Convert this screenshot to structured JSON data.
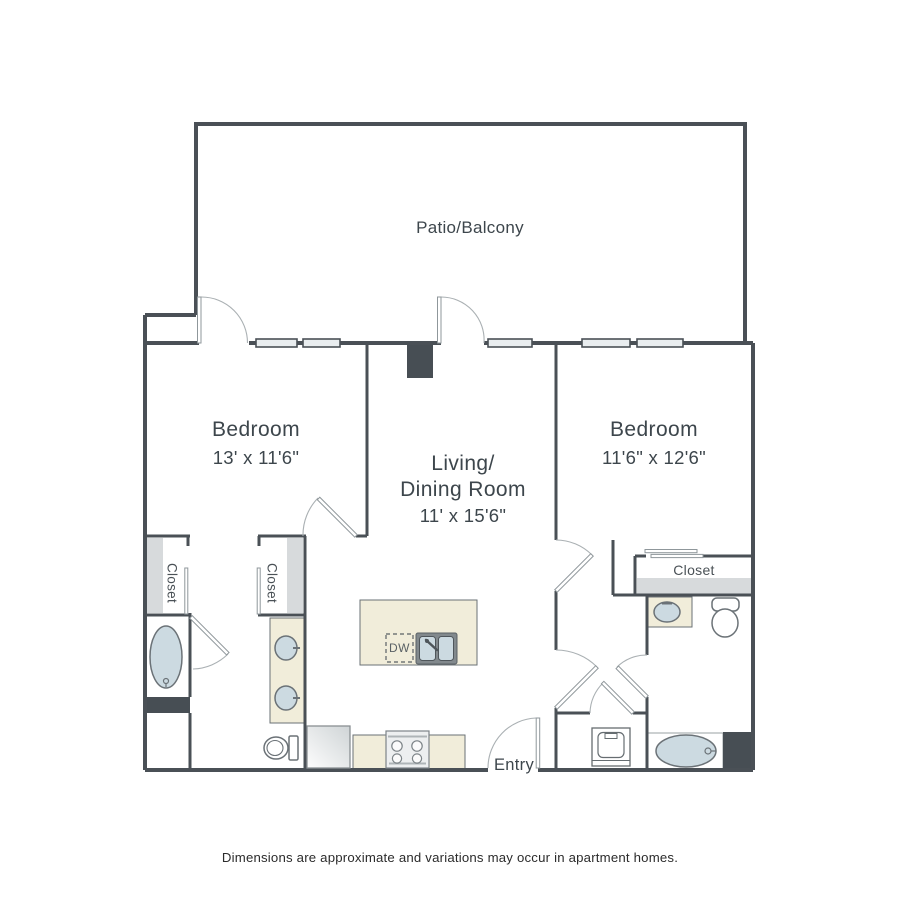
{
  "labels": {
    "patio": "Patio/Balcony",
    "bedroom_left": {
      "name": "Bedroom",
      "dims": "13' x 11'6\""
    },
    "living": {
      "line1": "Living/",
      "line2": "Dining Room",
      "dims": "11' x 15'6\""
    },
    "bedroom_right": {
      "name": "Bedroom",
      "dims": "11'6\" x 12'6\""
    },
    "closet_left": "Closet",
    "closet_mid": "Closet",
    "closet_right": "Closet",
    "entry": "Entry",
    "dishwasher": "DW",
    "disclaimer": "Dimensions are approximate and variations may occur in apartment homes."
  },
  "colors": {
    "wall": "#4a5056",
    "counter": "#f1edda",
    "fixture_fill": "#ccdae1",
    "shelf": "#d7dadc",
    "window": "#e9edef",
    "text": "#3d464c"
  }
}
